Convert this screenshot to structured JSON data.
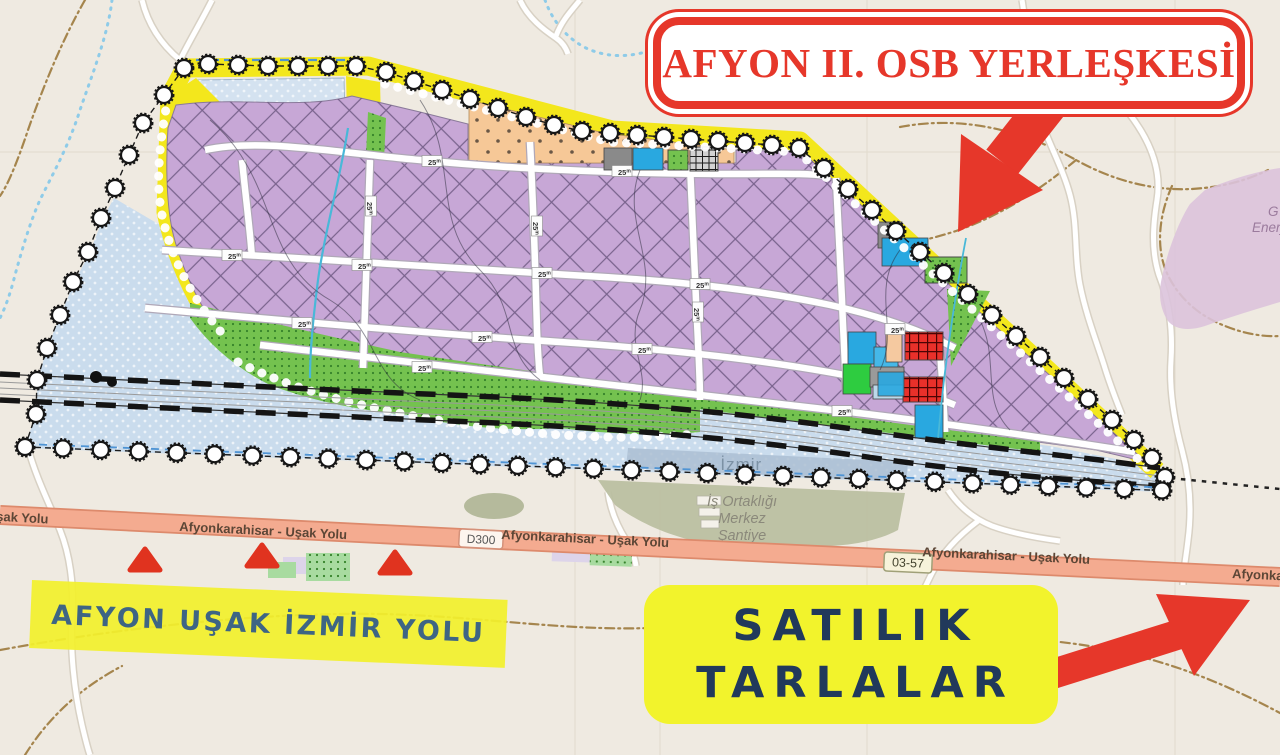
{
  "callouts": {
    "title": "AFYON II. OSB YERLEŞKESİ",
    "sale_line1": "SATILIK",
    "sale_line2": "TARLALAR",
    "road": "AFYON UŞAK İZMİR YOLU"
  },
  "map_labels": {
    "highway_name": "Afyonkarahisar - Uşak Yolu",
    "highway_name_left_partial": "şak Yolu",
    "route_badge_d300": "D300",
    "route_badge_provincial": "03-57",
    "district": "- İzmir",
    "site_line1": "İş Ortaklığı",
    "site_line2": "Merkez",
    "site_line3": "Şantiye",
    "energy_line1": "G",
    "energy_line2": "Enerji",
    "road_width": "25",
    "road_width_unit": "m"
  },
  "colors": {
    "accent_red": "#e6372a",
    "navy": "#21395b",
    "steel_blue": "#3e6584",
    "callout_yellow": "#f2f32c",
    "plan_parcel_purple": "#c7a7d6",
    "plan_border_yellow": "#f3e71c",
    "water_blue": "#cadced",
    "highway_salmon": "#f4ab90",
    "green_area": "#74c24f",
    "map_background": "#efeae1"
  }
}
